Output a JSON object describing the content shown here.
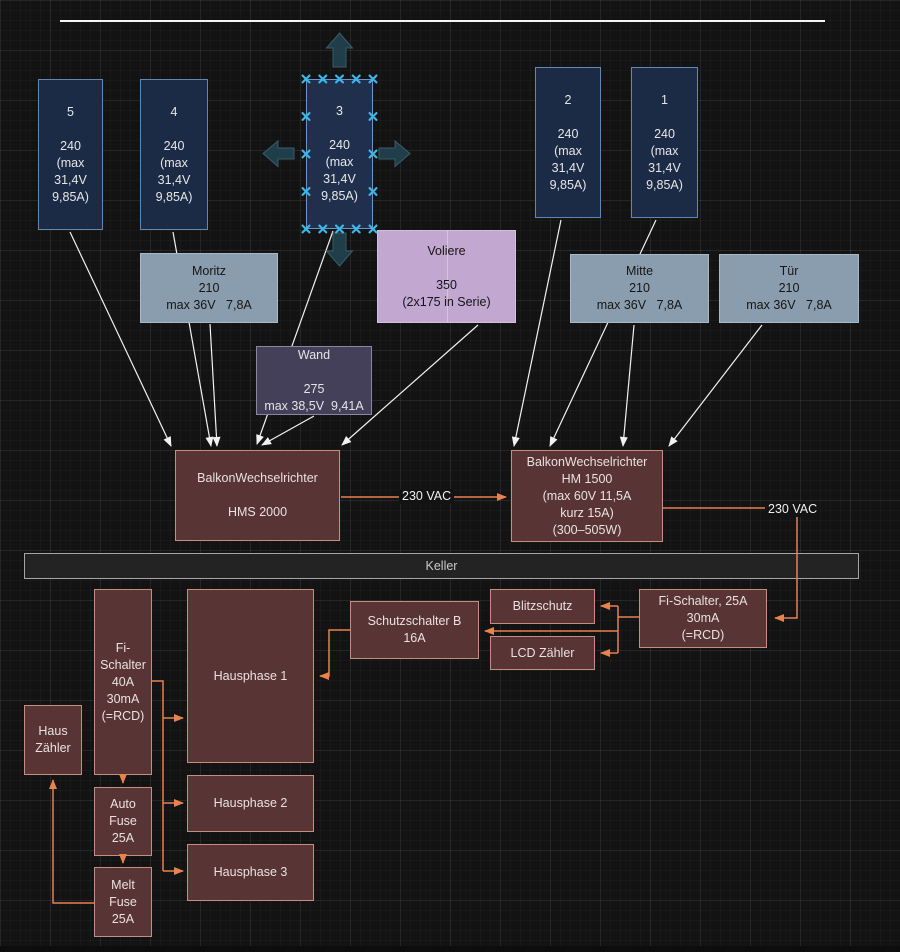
{
  "panels": {
    "panel5": {
      "label": "5\n\n240\n(max\n31,4V\n9,85A)"
    },
    "panel4": {
      "label": "4\n\n240\n(max\n31,4V\n9,85A)"
    },
    "panel3": {
      "label": "3\n\n240\n(max\n31,4V\n9,85A)"
    },
    "panel2": {
      "label": "2\n\n240\n(max\n31,4V\n9,85A)"
    },
    "panel1": {
      "label": "1\n\n240\n(max\n31,4V\n9,85A)"
    }
  },
  "strings": {
    "moritz": {
      "label": "Moritz\n210\nmax 36V   7,8A"
    },
    "voliere": {
      "label": "Voliere\n\n350\n(2x175 in Serie)"
    },
    "wand": {
      "label": "Wand\n\n275\nmax 38,5V  9,41A"
    },
    "mitte": {
      "label": "Mitte\n210\nmax 36V   7,8A"
    },
    "tuer": {
      "label": "Tür\n210\nmax 36V   7,8A"
    }
  },
  "inverters": {
    "hms2000": {
      "label": "BalkonWechselrichter\n\nHMS 2000"
    },
    "hm1500": {
      "label": "BalkonWechselrichter\nHM 1500\n(max 60V 11,5A\nkurz 15A)\n(300–505W)"
    }
  },
  "edge_labels": {
    "vac_left": "230 VAC",
    "vac_right": "230 VAC"
  },
  "keller": {
    "label": "Keller"
  },
  "house": {
    "fi40": {
      "label": "Fi-\nSchalter\n40A\n30mA\n(=RCD)"
    },
    "haus_zaehler": {
      "label": "Haus\nZähler"
    },
    "auto_fuse": {
      "label": "Auto\nFuse\n25A"
    },
    "melt_fuse": {
      "label": "Melt\nFuse\n25A"
    },
    "hausphase1": {
      "label": "Hausphase 1"
    },
    "hausphase2": {
      "label": "Hausphase 2"
    },
    "hausphase3": {
      "label": "Hausphase 3"
    },
    "schutzschalter": {
      "label": "Schutzschalter B\n16A"
    },
    "blitzschutz": {
      "label": "Blitzschutz"
    },
    "lcd_zaehler": {
      "label": "LCD Zähler"
    },
    "fi25": {
      "label": "Fi-Schalter, 25A\n30mA\n(=RCD)"
    }
  },
  "colors": {
    "canvas_bg": "#131313",
    "connector_white": "#f2f2f2",
    "connector_orange": "#e8824e",
    "selection_cyan": "#3ab8ec",
    "direction_arrow": "#21404d",
    "panel_navy": "#1b2b45",
    "panel_border": "#6188b1",
    "string_steel": "#8a9dae",
    "voliere_lilac": "#c2a7d0",
    "wand_plum": "#454059",
    "box_maroon": "#583434",
    "maroon_border": "#c68e7e"
  }
}
